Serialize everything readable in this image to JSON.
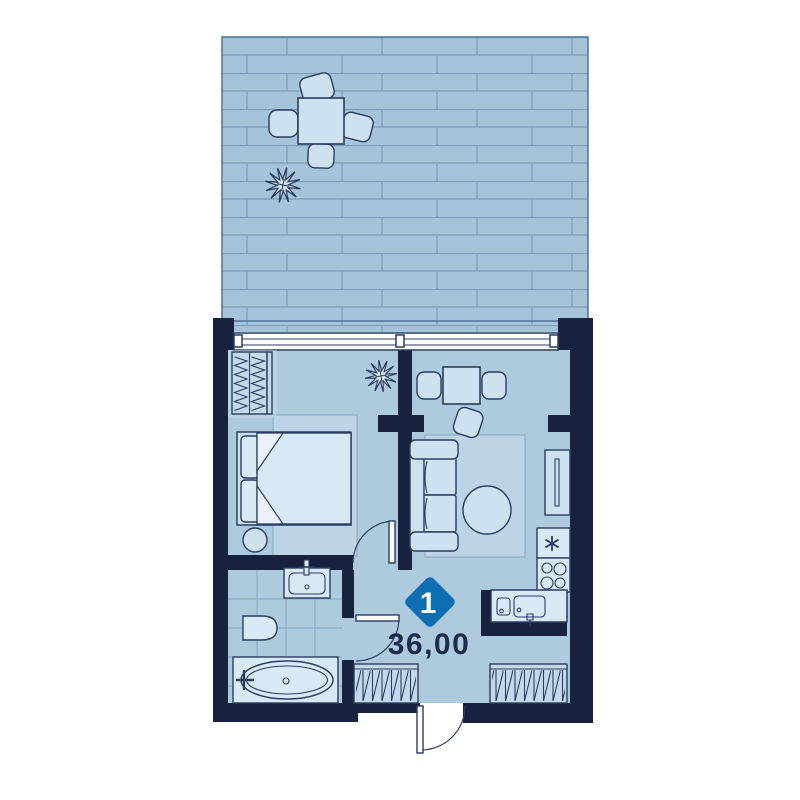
{
  "plan": {
    "unit_badge": "1",
    "area_label": "36,00"
  },
  "colors": {
    "page_bg": "#ffffff",
    "wall": "#17223e",
    "floor": "#adcade",
    "terrace": "#a5c3d9",
    "plank_line": "#7d9cba",
    "terrace_border": "#587a97",
    "furniture_fill": "#cde1f1",
    "furniture_light": "#d8e9f6",
    "closet_fill": "#c3d9eb",
    "rug_fill": "#bdd4e7",
    "rug_line": "#8aabc8",
    "outline": "#2b3d60",
    "tile_line": "#85a6c4",
    "window_fill": "#ffffff",
    "badge_bg": "#0d6eb2",
    "badge_text": "#ffffff",
    "area_text": "#1c2b4d"
  },
  "symbols": [
    "terrace-with-plank-decking",
    "terrace-table-icon",
    "terrace-chair-icon",
    "plant-icon",
    "window-band",
    "wardrobe-icon",
    "double-bed-icon",
    "bedside-table-icon",
    "bedroom-rug",
    "dining-table-icon",
    "dining-chair-icon",
    "sofa-icon",
    "coffee-table-icon",
    "living-room-rug",
    "tv-stand-icon",
    "fridge-icon",
    "stove-icon",
    "kitchen-sink-icon",
    "bathroom-sink-icon",
    "toilet-icon",
    "bathtub-icon",
    "tiled-bathroom-floor",
    "interior-door-icon",
    "entry-door-icon",
    "closet-hatch"
  ]
}
